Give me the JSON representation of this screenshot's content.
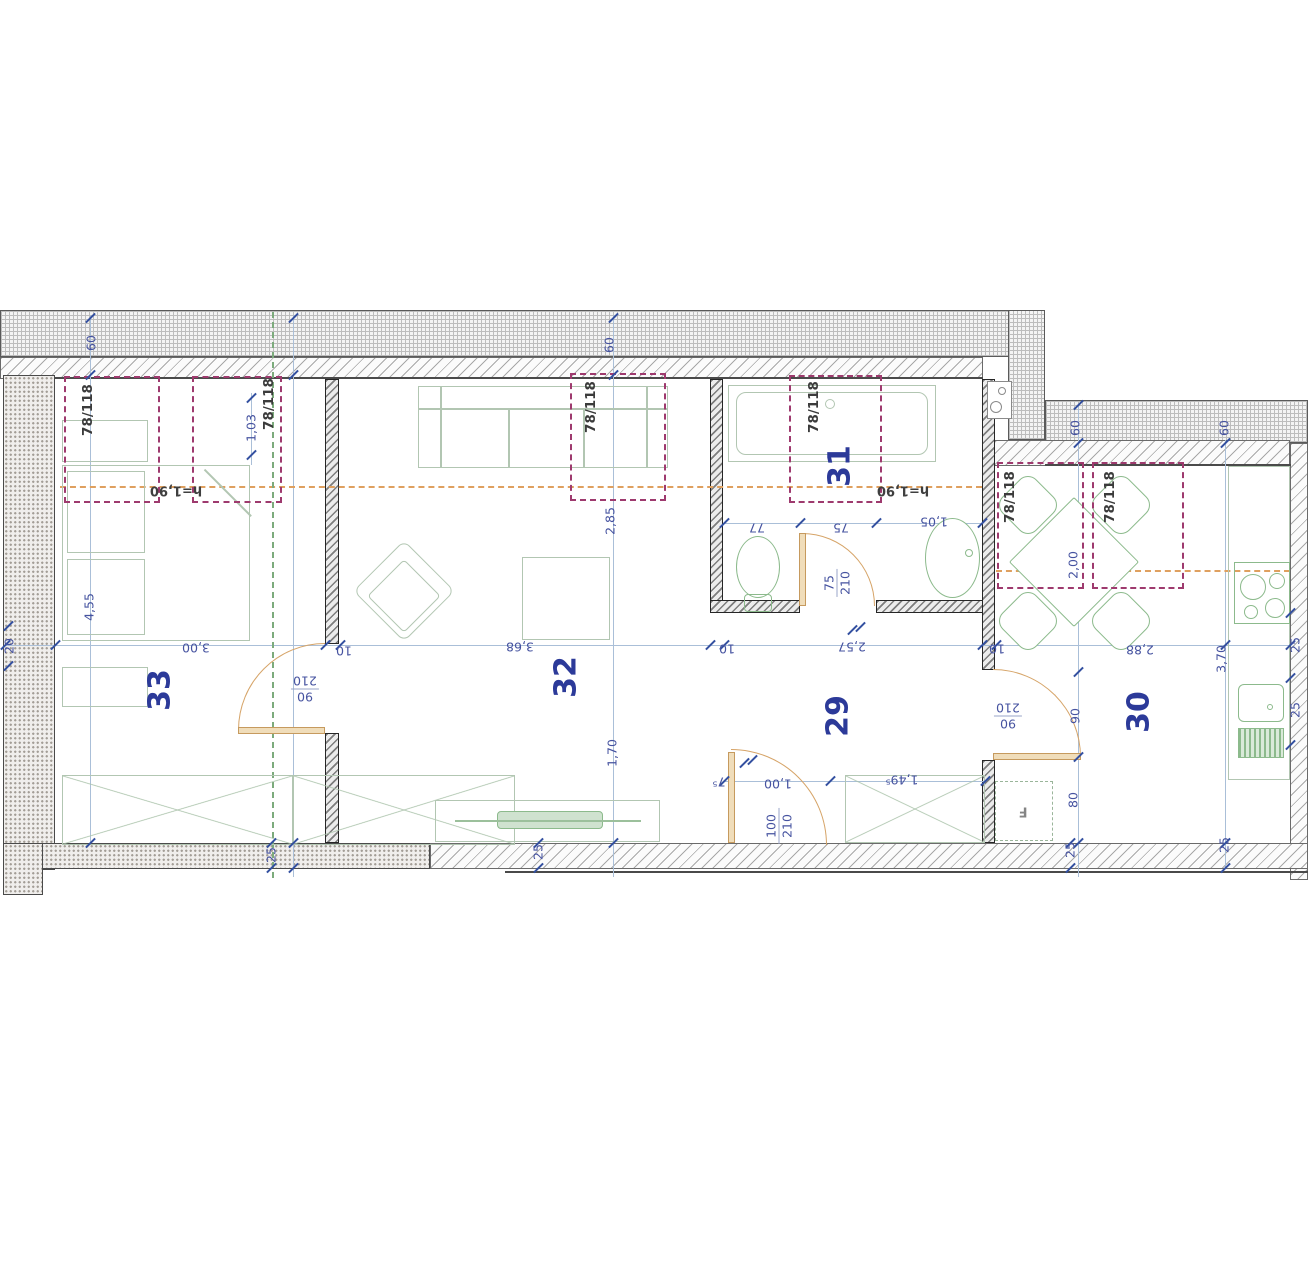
{
  "plan": {
    "rooms": [
      {
        "label": "33",
        "x": 160,
        "y": 690
      },
      {
        "label": "32",
        "x": 566,
        "y": 677
      },
      {
        "label": "31",
        "x": 840,
        "y": 466
      },
      {
        "label": "29",
        "x": 838,
        "y": 716
      },
      {
        "label": "30",
        "x": 1139,
        "y": 712
      }
    ],
    "windows": [
      {
        "label": "78/118",
        "x": 64,
        "y": 376,
        "w": 96,
        "h": 127,
        "lx": 88,
        "ly": 410
      },
      {
        "label": "78/118",
        "x": 192,
        "y": 376,
        "w": 90,
        "h": 127,
        "lx": 269,
        "ly": 404
      },
      {
        "label": "78/118",
        "x": 570,
        "y": 373,
        "w": 96,
        "h": 128,
        "lx": 591,
        "ly": 407
      },
      {
        "label": "78/118",
        "x": 789,
        "y": 375,
        "w": 93,
        "h": 128,
        "lx": 814,
        "ly": 407
      },
      {
        "label": "78/118",
        "x": 997,
        "y": 462,
        "w": 87,
        "h": 127,
        "lx": 1010,
        "ly": 497
      },
      {
        "label": "78/118",
        "x": 1092,
        "y": 462,
        "w": 92,
        "h": 127,
        "lx": 1110,
        "ly": 497
      }
    ],
    "height_labels": [
      {
        "text": "h=1,90",
        "x": 176,
        "y": 490,
        "r": 180
      },
      {
        "text": "h=1,90",
        "x": 903,
        "y": 490,
        "r": 180
      }
    ],
    "door_labels": [
      {
        "num": "90",
        "den": "210",
        "x": 305,
        "y": 689,
        "r": 180
      },
      {
        "num": "75",
        "den": "210",
        "x": 837,
        "y": 583,
        "r": -90
      },
      {
        "num": "100",
        "den": "210",
        "x": 779,
        "y": 826,
        "r": -90
      },
      {
        "num": "90",
        "den": "210",
        "x": 1008,
        "y": 716,
        "r": 180
      }
    ],
    "fridge_label": {
      "text": "F",
      "x": 1023,
      "y": 811,
      "r": 180
    },
    "dims": [
      {
        "text": "60",
        "x": 91,
        "y": 343,
        "r": -90
      },
      {
        "text": "60",
        "x": 609,
        "y": 345,
        "r": -90
      },
      {
        "text": "60",
        "x": 1075,
        "y": 428,
        "r": -90
      },
      {
        "text": "60",
        "x": 1224,
        "y": 428,
        "r": -90
      },
      {
        "text": "1,03",
        "x": 251,
        "y": 428,
        "r": -90
      },
      {
        "text": "4,55",
        "x": 89,
        "y": 607,
        "r": -90
      },
      {
        "text": "20",
        "x": 9,
        "y": 646,
        "r": -90
      },
      {
        "text": "3,00",
        "x": 196,
        "y": 648,
        "r": 180
      },
      {
        "text": "10",
        "x": 344,
        "y": 651,
        "r": 180
      },
      {
        "text": "3,68",
        "x": 520,
        "y": 647,
        "r": 180
      },
      {
        "text": "10",
        "x": 727,
        "y": 649,
        "r": 180
      },
      {
        "text": "2,57",
        "x": 852,
        "y": 647,
        "r": 180
      },
      {
        "text": "10",
        "x": 997,
        "y": 649,
        "r": 180
      },
      {
        "text": "2,88",
        "x": 1140,
        "y": 650,
        "r": 180
      },
      {
        "text": "3,70",
        "x": 1221,
        "y": 659,
        "r": -90
      },
      {
        "text": "2,85",
        "x": 610,
        "y": 521,
        "r": -90
      },
      {
        "text": "1,70",
        "x": 612,
        "y": 753,
        "r": -90
      },
      {
        "text": "77",
        "x": 757,
        "y": 528,
        "r": 180
      },
      {
        "text": "75",
        "x": 841,
        "y": 528,
        "r": 180
      },
      {
        "text": "1,05",
        "x": 934,
        "y": 522,
        "r": 180
      },
      {
        "text": "2,00",
        "x": 1073,
        "y": 565,
        "r": -90
      },
      {
        "text": "90",
        "x": 1075,
        "y": 716,
        "r": -90
      },
      {
        "text": "80",
        "x": 1073,
        "y": 800,
        "r": -90
      },
      {
        "text": "7⁵",
        "x": 719,
        "y": 782,
        "r": 180
      },
      {
        "text": "1,00",
        "x": 778,
        "y": 784,
        "r": 180
      },
      {
        "text": "1,49⁵",
        "x": 902,
        "y": 780,
        "r": 180
      },
      {
        "text": "25",
        "x": 271,
        "y": 855,
        "r": -90
      },
      {
        "text": "25",
        "x": 538,
        "y": 852,
        "r": -90
      },
      {
        "text": "25",
        "x": 1070,
        "y": 850,
        "r": -90
      },
      {
        "text": "25",
        "x": 1224,
        "y": 845,
        "r": -90
      },
      {
        "text": "25",
        "x": 1295,
        "y": 645,
        "r": -90
      },
      {
        "text": "25",
        "x": 1295,
        "y": 710,
        "r": -90
      }
    ],
    "walls": [
      {
        "cls": "wall-grid",
        "n": "outer-wall-top-grid",
        "x": 0,
        "y": 310,
        "w": 1013,
        "h": 47
      },
      {
        "cls": "wall-diag",
        "n": "outer-wall-top-inner",
        "x": 0,
        "y": 357,
        "w": 983,
        "h": 22
      },
      {
        "cls": "wall-grid",
        "n": "outer-wall-corner",
        "x": 1008,
        "y": 310,
        "w": 37,
        "h": 130
      },
      {
        "cls": "wall-grid",
        "n": "outer-wall-topright-grid",
        "x": 1045,
        "y": 400,
        "w": 263,
        "h": 43
      },
      {
        "cls": "wall-diag",
        "n": "outer-wall-topright-inner",
        "x": 983,
        "y": 440,
        "w": 307,
        "h": 26
      },
      {
        "cls": "wall-diag",
        "n": "outer-wall-right",
        "x": 1290,
        "y": 443,
        "w": 18,
        "h": 437
      },
      {
        "cls": "wall-stip",
        "n": "outer-wall-left",
        "x": 3,
        "y": 375,
        "w": 52,
        "h": 495
      },
      {
        "cls": "wall-stip",
        "n": "outer-wall-bottom-left",
        "x": 3,
        "y": 843,
        "w": 427,
        "h": 26
      },
      {
        "cls": "wall-stip",
        "n": "outer-wall-bottom-corner",
        "x": 3,
        "y": 843,
        "w": 40,
        "h": 52
      },
      {
        "cls": "wall-diag",
        "n": "outer-wall-bottom-right",
        "x": 430,
        "y": 843,
        "w": 878,
        "h": 26
      },
      {
        "cls": "wall-int",
        "n": "wall-33-32-upper",
        "x": 325,
        "y": 379,
        "w": 14,
        "h": 265
      },
      {
        "cls": "wall-int",
        "n": "wall-33-32-lower",
        "x": 325,
        "y": 733,
        "w": 14,
        "h": 110
      },
      {
        "cls": "wall-int",
        "n": "wall-32-31",
        "x": 710,
        "y": 379,
        "w": 13,
        "h": 234
      },
      {
        "cls": "wall-int",
        "n": "wall-bath-bottom-left",
        "x": 710,
        "y": 600,
        "w": 90,
        "h": 13
      },
      {
        "cls": "wall-int",
        "n": "wall-bath-bottom-right",
        "x": 876,
        "y": 600,
        "w": 119,
        "h": 13
      },
      {
        "cls": "wall-int",
        "n": "wall-hall-30-upper",
        "x": 982,
        "y": 379,
        "w": 13,
        "h": 291
      },
      {
        "cls": "wall-int",
        "n": "wall-hall-30-lower",
        "x": 982,
        "y": 760,
        "w": 13,
        "h": 83
      }
    ],
    "edges": [
      {
        "x": 505,
        "y": 871,
        "w": 803,
        "h": 2
      },
      {
        "x": 55,
        "y": 377,
        "w": 928,
        "h": 2
      },
      {
        "x": 1045,
        "y": 464,
        "w": 246,
        "h": 2
      }
    ],
    "dim_lines": [
      {
        "x": 5,
        "y": 645,
        "w": 1285,
        "h": 1
      },
      {
        "x": 90,
        "y": 315,
        "w": 1,
        "h": 530
      },
      {
        "x": 293,
        "y": 315,
        "w": 1,
        "h": 562
      },
      {
        "x": 613,
        "y": 315,
        "w": 1,
        "h": 562
      },
      {
        "x": 1078,
        "y": 405,
        "w": 1,
        "h": 472
      },
      {
        "x": 1225,
        "y": 440,
        "w": 1,
        "h": 428
      },
      {
        "x": 724,
        "y": 523,
        "w": 258,
        "h": 1
      },
      {
        "x": 724,
        "y": 781,
        "w": 261,
        "h": 1
      },
      {
        "x": 251,
        "y": 393,
        "w": 1,
        "h": 72
      }
    ],
    "dash_lines": [
      {
        "kind": "h190",
        "n": "height-190-line-left",
        "x": 60,
        "y": 486,
        "w": 922
      },
      {
        "kind": "h190",
        "n": "height-190-line-right",
        "x": 996,
        "y": 570,
        "w": 294
      },
      {
        "kind": "ridge",
        "n": "roof-ridge-line",
        "x": 272,
        "y": 312,
        "h": 566
      }
    ],
    "ticks": [
      [
        5,
        645
      ],
      [
        55,
        645
      ],
      [
        325,
        645
      ],
      [
        340,
        645
      ],
      [
        710,
        645
      ],
      [
        724,
        645
      ],
      [
        982,
        645
      ],
      [
        996,
        645
      ],
      [
        1290,
        645
      ],
      [
        1225,
        645
      ],
      [
        724,
        523
      ],
      [
        800,
        523
      ],
      [
        876,
        523
      ],
      [
        982,
        523
      ],
      [
        724,
        781
      ],
      [
        830,
        781
      ],
      [
        985,
        781
      ],
      [
        293,
        318
      ],
      [
        293,
        375
      ],
      [
        293,
        843
      ],
      [
        293,
        868
      ],
      [
        613,
        318
      ],
      [
        613,
        375
      ],
      [
        613,
        843
      ],
      [
        90,
        318
      ],
      [
        90,
        375
      ],
      [
        90,
        843
      ],
      [
        1078,
        405
      ],
      [
        1078,
        443
      ],
      [
        1078,
        672
      ],
      [
        1078,
        757
      ],
      [
        1078,
        843
      ],
      [
        1225,
        443
      ],
      [
        1225,
        843
      ],
      [
        1225,
        868
      ],
      [
        1290,
        613
      ],
      [
        1290,
        678
      ],
      [
        1290,
        745
      ],
      [
        8,
        626
      ],
      [
        8,
        666
      ],
      [
        271,
        843
      ],
      [
        271,
        868
      ],
      [
        538,
        843
      ],
      [
        538,
        868
      ],
      [
        1070,
        843
      ],
      [
        1070,
        868
      ],
      [
        251,
        398
      ],
      [
        251,
        455
      ],
      [
        852,
        630
      ],
      [
        860,
        627
      ],
      [
        744,
        763
      ],
      [
        752,
        760
      ]
    ],
    "doors": {
      "leaves": [
        {
          "n": "door-33-32-leaf",
          "x": 238,
          "y": 727,
          "w": 87,
          "h": 7
        },
        {
          "n": "entry-door-leaf",
          "x": 728,
          "y": 752,
          "w": 7,
          "h": 91
        },
        {
          "n": "bath-door-leaf",
          "x": 799,
          "y": 533,
          "w": 7,
          "h": 73
        },
        {
          "n": "door-29-30-leaf",
          "x": 993,
          "y": 753,
          "w": 88,
          "h": 7
        }
      ],
      "arcs": [
        {
          "n": "door-33-32-swing",
          "x": 238,
          "y": 643,
          "r": 87,
          "q": "tl"
        },
        {
          "n": "entry-door-swing",
          "x": 731,
          "y": 749,
          "r": 96,
          "q": "tr"
        },
        {
          "n": "bath-door-swing",
          "x": 802,
          "y": 533,
          "r": 73,
          "q": "tr"
        },
        {
          "n": "door-29-30-swing",
          "x": 993,
          "y": 669,
          "r": 88,
          "q": "tr"
        }
      ]
    },
    "furniture": [
      {
        "k": "rect",
        "cls": "furn",
        "n": "nightstand",
        "x": 62,
        "y": 420,
        "w": 86,
        "h": 42
      },
      {
        "k": "rect",
        "cls": "furn",
        "n": "bed",
        "x": 62,
        "y": 465,
        "w": 188,
        "h": 176
      },
      {
        "k": "rect",
        "cls": "furn",
        "n": "bed-pillow",
        "x": 67,
        "y": 471,
        "w": 78,
        "h": 82
      },
      {
        "k": "rect",
        "cls": "furn",
        "n": "bed-pillow",
        "x": 67,
        "y": 559,
        "w": 78,
        "h": 76
      },
      {
        "k": "line",
        "cls": "",
        "n": "bed-fold-line",
        "x": 228,
        "y": 492,
        "w": 66,
        "rot": 45,
        "c": "#b2c6b2"
      },
      {
        "k": "rect",
        "cls": "furn",
        "n": "bedroom-bench",
        "x": 62,
        "y": 667,
        "w": 86,
        "h": 40
      },
      {
        "k": "xbox",
        "n": "wardrobe",
        "x": 62,
        "y": 775,
        "w": 231,
        "h": 70
      },
      {
        "k": "xbox",
        "n": "wardrobe",
        "x": 293,
        "y": 775,
        "w": 222,
        "h": 70
      },
      {
        "k": "rect",
        "cls": "furn",
        "n": "sofa",
        "x": 418,
        "y": 386,
        "w": 250,
        "h": 82
      },
      {
        "k": "line",
        "cls": "",
        "n": "sofa-back-line",
        "x": 543,
        "y": 408,
        "w": 250,
        "rot": 0,
        "c": "#b2c6b2"
      },
      {
        "k": "vline",
        "n": "sofa-armrest",
        "x": 440,
        "y": 386,
        "h": 82,
        "c": "#b2c6b2"
      },
      {
        "k": "vline",
        "n": "sofa-armrest",
        "x": 646,
        "y": 386,
        "h": 82,
        "c": "#b2c6b2"
      },
      {
        "k": "vline",
        "n": "sofa-cushion-divider",
        "x": 508,
        "y": 408,
        "h": 60,
        "c": "#b2c6b2"
      },
      {
        "k": "vline",
        "n": "sofa-cushion-divider",
        "x": 583,
        "y": 408,
        "h": 60,
        "c": "#b2c6b2"
      },
      {
        "k": "dia",
        "cls": "furn wht",
        "n": "armchair",
        "x": 404,
        "y": 591,
        "s": 72,
        "rad": "8px"
      },
      {
        "k": "dia",
        "cls": "furn wht",
        "n": "armchair-seat",
        "x": 404,
        "y": 596,
        "s": 52,
        "rad": "4px"
      },
      {
        "k": "rect",
        "cls": "furn",
        "n": "coffee-table",
        "x": 522,
        "y": 557,
        "w": 88,
        "h": 83
      },
      {
        "k": "rect",
        "cls": "furn",
        "n": "tv-lowboard",
        "x": 435,
        "y": 800,
        "w": 225,
        "h": 42
      },
      {
        "k": "tvbar",
        "n": "tv-set",
        "x": 497,
        "y": 811,
        "w": 106,
        "h": 18
      },
      {
        "k": "line",
        "cls": "",
        "n": "tv-shelf-line",
        "x": 548,
        "y": 820,
        "w": 186,
        "rot": 0,
        "c": "#9cc09c"
      },
      {
        "k": "xbox",
        "n": "hall-wardrobe",
        "x": 845,
        "y": 775,
        "w": 140,
        "h": 68
      },
      {
        "k": "rect",
        "cls": "furn",
        "n": "bathtub",
        "x": 728,
        "y": 385,
        "w": 208,
        "h": 77
      },
      {
        "k": "rect",
        "cls": "furn",
        "n": "bathtub-inner",
        "x": 736,
        "y": 392,
        "w": 192,
        "h": 63,
        "rad": "10px"
      },
      {
        "k": "circ",
        "cls": "furn",
        "n": "bathtub-drain",
        "x": 830,
        "y": 404,
        "r": 5
      },
      {
        "k": "ell",
        "cls": "furng wht",
        "n": "toilet",
        "x": 736,
        "y": 536,
        "w": 44,
        "h": 62
      },
      {
        "k": "rect",
        "cls": "furng",
        "n": "toilet-base",
        "x": 744,
        "y": 594,
        "w": 28,
        "h": 18,
        "rad": "4px"
      },
      {
        "k": "ell",
        "cls": "furng wht",
        "n": "bath-sink",
        "x": 925,
        "y": 518,
        "w": 55,
        "h": 80
      },
      {
        "k": "circ",
        "cls": "furng",
        "n": "bath-faucet",
        "x": 969,
        "y": 553,
        "r": 4
      },
      {
        "k": "dia",
        "cls": "furng wht",
        "n": "dining-chair",
        "x": 1028,
        "y": 505,
        "s": 48,
        "rad": "12px"
      },
      {
        "k": "dia",
        "cls": "furng wht",
        "n": "dining-chair",
        "x": 1121,
        "y": 505,
        "s": 48,
        "rad": "12px"
      },
      {
        "k": "dia",
        "cls": "furng wht",
        "n": "dining-chair",
        "x": 1028,
        "y": 621,
        "s": 48,
        "rad": "12px"
      },
      {
        "k": "dia",
        "cls": "furng wht",
        "n": "dining-chair",
        "x": 1121,
        "y": 621,
        "s": 48,
        "rad": "12px"
      },
      {
        "k": "dia",
        "cls": "furng wht",
        "n": "dining-table",
        "x": 1074,
        "y": 562,
        "s": 92,
        "rad": "2px"
      },
      {
        "k": "rect",
        "cls": "furn",
        "n": "kitchen-counter",
        "x": 1228,
        "y": 466,
        "w": 62,
        "h": 314
      },
      {
        "k": "rect",
        "cls": "furng",
        "n": "stove",
        "x": 1234,
        "y": 562,
        "w": 56,
        "h": 62
      },
      {
        "k": "circ",
        "cls": "furng",
        "n": "stove-burner",
        "x": 1253,
        "y": 587,
        "r": 13
      },
      {
        "k": "circ",
        "cls": "furng",
        "n": "stove-burner",
        "x": 1277,
        "y": 581,
        "r": 8
      },
      {
        "k": "circ",
        "cls": "furng",
        "n": "stove-burner",
        "x": 1251,
        "y": 612,
        "r": 7
      },
      {
        "k": "circ",
        "cls": "furng",
        "n": "stove-burner",
        "x": 1275,
        "y": 608,
        "r": 10
      },
      {
        "k": "rect",
        "cls": "furng",
        "n": "kitchen-sink",
        "x": 1238,
        "y": 684,
        "w": 46,
        "h": 38,
        "rad": "6px"
      },
      {
        "k": "circ",
        "cls": "furng",
        "n": "kitchen-faucet",
        "x": 1270,
        "y": 707,
        "r": 3
      },
      {
        "k": "stripes",
        "n": "sink-drainer",
        "x": 1238,
        "y": 728,
        "w": 46,
        "h": 30
      },
      {
        "k": "dashrect",
        "n": "fridge",
        "x": 995,
        "y": 781,
        "w": 58,
        "h": 60
      },
      {
        "k": "rect",
        "cls": "",
        "n": "appliance-niche",
        "x": 987,
        "y": 381,
        "w": 25,
        "h": 38,
        "rad": "0",
        "bd": "1px solid #8a8a8a",
        "bg": "#ffffff"
      },
      {
        "k": "circ",
        "cls": "",
        "n": "niche-appliance-burner",
        "x": 1002,
        "y": 391,
        "r": 4,
        "bd": "1px solid #8a8a8a"
      },
      {
        "k": "circ",
        "cls": "",
        "n": "niche-appliance-burner",
        "x": 996,
        "y": 407,
        "r": 6,
        "bd": "1px solid #8a8a8a"
      }
    ]
  }
}
